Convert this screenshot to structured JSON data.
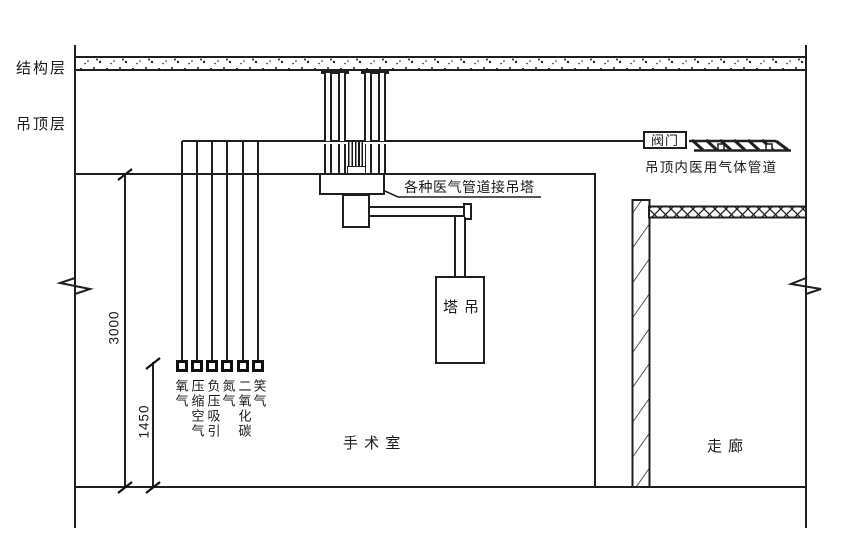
{
  "layers": {
    "structural": "结构层",
    "ceiling": "吊顶层"
  },
  "annotations": {
    "pendant_connection": "各种医气管道接吊塔",
    "valve": "阀门",
    "ceiling_gas_pipeline": "吊顶内医用气体管道"
  },
  "equipment": {
    "pendant": "吊塔"
  },
  "rooms": {
    "operating_room": "手 术 室",
    "corridor": "走 廊"
  },
  "dimensions": [
    {
      "value": "3000"
    },
    {
      "value": "1450"
    }
  ],
  "gases": [
    {
      "label": "氧气"
    },
    {
      "label": "压缩空气"
    },
    {
      "label": "负压吸引"
    },
    {
      "label": "氮气"
    },
    {
      "label": "二氧化碳"
    },
    {
      "label": "笑气"
    }
  ],
  "colors": {
    "ink": "#1f1f1f",
    "background": "#ffffff"
  }
}
